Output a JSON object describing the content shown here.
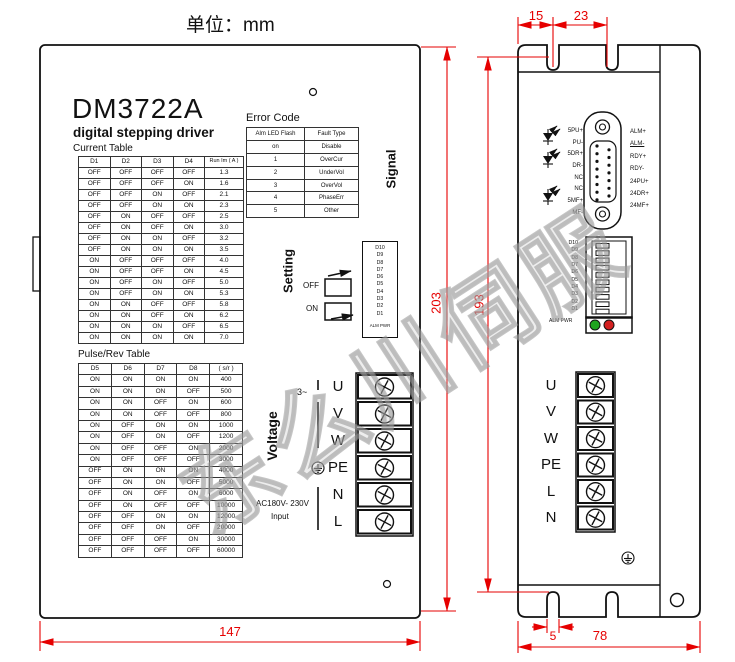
{
  "unit_label": "单位：mm",
  "watermark": "东么川伺服",
  "colors": {
    "dimension_red": "#e60000",
    "led_green": "#1fa41f",
    "led_red": "#d42020"
  },
  "left_device": {
    "model": "DM3722A",
    "subtitle": "digital stepping driver",
    "signal_label": "Signal",
    "setting_label": "Setting",
    "voltage_label": "Voltage",
    "switch_off": "OFF",
    "switch_on": "ON",
    "phase_label": "3~",
    "ac_input": "AC180V- 230V",
    "ac_input2": "Input",
    "dip_footer": "ALM PWR",
    "dip_labels": [
      "D10",
      "D9",
      "D8",
      "D7",
      "D6",
      "D5",
      "D4",
      "D3",
      "D2",
      "D1"
    ],
    "terminals": [
      "U",
      "V",
      "W",
      "PE",
      "N",
      "L"
    ],
    "current_table": {
      "title": "Current Table",
      "headers": [
        "D1",
        "D2",
        "D3",
        "D4",
        "Run Im ( A )"
      ],
      "rows": [
        [
          "OFF",
          "OFF",
          "OFF",
          "OFF",
          "1.3"
        ],
        [
          "OFF",
          "OFF",
          "OFF",
          "ON",
          "1.6"
        ],
        [
          "OFF",
          "OFF",
          "ON",
          "OFF",
          "2.1"
        ],
        [
          "OFF",
          "OFF",
          "ON",
          "ON",
          "2.3"
        ],
        [
          "OFF",
          "ON",
          "OFF",
          "OFF",
          "2.5"
        ],
        [
          "OFF",
          "ON",
          "OFF",
          "ON",
          "3.0"
        ],
        [
          "OFF",
          "ON",
          "ON",
          "OFF",
          "3.2"
        ],
        [
          "OFF",
          "ON",
          "ON",
          "ON",
          "3.5"
        ],
        [
          "ON",
          "OFF",
          "OFF",
          "OFF",
          "4.0"
        ],
        [
          "ON",
          "OFF",
          "OFF",
          "ON",
          "4.5"
        ],
        [
          "ON",
          "OFF",
          "ON",
          "OFF",
          "5.0"
        ],
        [
          "ON",
          "OFF",
          "ON",
          "ON",
          "5.3"
        ],
        [
          "ON",
          "ON",
          "OFF",
          "OFF",
          "5.8"
        ],
        [
          "ON",
          "ON",
          "OFF",
          "ON",
          "6.2"
        ],
        [
          "ON",
          "ON",
          "ON",
          "OFF",
          "6.5"
        ],
        [
          "ON",
          "ON",
          "ON",
          "ON",
          "7.0"
        ]
      ]
    },
    "pulse_table": {
      "title": "Pulse/Rev Table",
      "headers": [
        "D5",
        "D6",
        "D7",
        "D8",
        "( s/r )"
      ],
      "rows": [
        [
          "ON",
          "ON",
          "ON",
          "ON",
          "400"
        ],
        [
          "ON",
          "ON",
          "ON",
          "OFF",
          "500"
        ],
        [
          "ON",
          "ON",
          "OFF",
          "ON",
          "600"
        ],
        [
          "ON",
          "ON",
          "OFF",
          "OFF",
          "800"
        ],
        [
          "ON",
          "OFF",
          "ON",
          "ON",
          "1000"
        ],
        [
          "ON",
          "OFF",
          "ON",
          "OFF",
          "1200"
        ],
        [
          "ON",
          "OFF",
          "OFF",
          "ON",
          "2000"
        ],
        [
          "ON",
          "OFF",
          "OFF",
          "OFF",
          "3000"
        ],
        [
          "OFF",
          "ON",
          "ON",
          "ON",
          "4000"
        ],
        [
          "OFF",
          "ON",
          "ON",
          "OFF",
          "5000"
        ],
        [
          "OFF",
          "ON",
          "OFF",
          "ON",
          "6000"
        ],
        [
          "OFF",
          "ON",
          "OFF",
          "OFF",
          "10000"
        ],
        [
          "OFF",
          "OFF",
          "ON",
          "ON",
          "12000"
        ],
        [
          "OFF",
          "OFF",
          "ON",
          "OFF",
          "20000"
        ],
        [
          "OFF",
          "OFF",
          "OFF",
          "ON",
          "30000"
        ],
        [
          "OFF",
          "OFF",
          "OFF",
          "OFF",
          "60000"
        ]
      ]
    },
    "error_table": {
      "title": "Error Code",
      "headers": [
        "Alm LED Flash",
        "Fault Type"
      ],
      "rows": [
        [
          "on",
          "Disable"
        ],
        [
          "1",
          "OverCur"
        ],
        [
          "2",
          "UnderVol"
        ],
        [
          "3",
          "OverVol"
        ],
        [
          "4",
          "PhaseErr"
        ],
        [
          "5",
          "Other"
        ]
      ]
    }
  },
  "right_device": {
    "connector_left_labels": [
      "5PU+",
      "PU-",
      "5DR+",
      "DR-",
      "NC",
      "NC",
      "5MF+",
      "MF-"
    ],
    "connector_right_labels": [
      "ALM+",
      "ALM-",
      "RDY+",
      "RDY-",
      "24PU+",
      "24DR+",
      "24MF+"
    ],
    "dip_labels": [
      "D10",
      "D9",
      "D8",
      "D7",
      "D6",
      "D5",
      "D4",
      "D3",
      "D2",
      "D1"
    ],
    "dip_footer": "ALM PWR",
    "terminals": [
      "U",
      "V",
      "W",
      "PE",
      "L",
      "N"
    ]
  },
  "dimensions": {
    "flange_left": "15",
    "flange_mid": "23",
    "height_overall": "203",
    "height_mounting": "193",
    "width_overall": "147",
    "slot_width": "5",
    "width_right": "78"
  }
}
